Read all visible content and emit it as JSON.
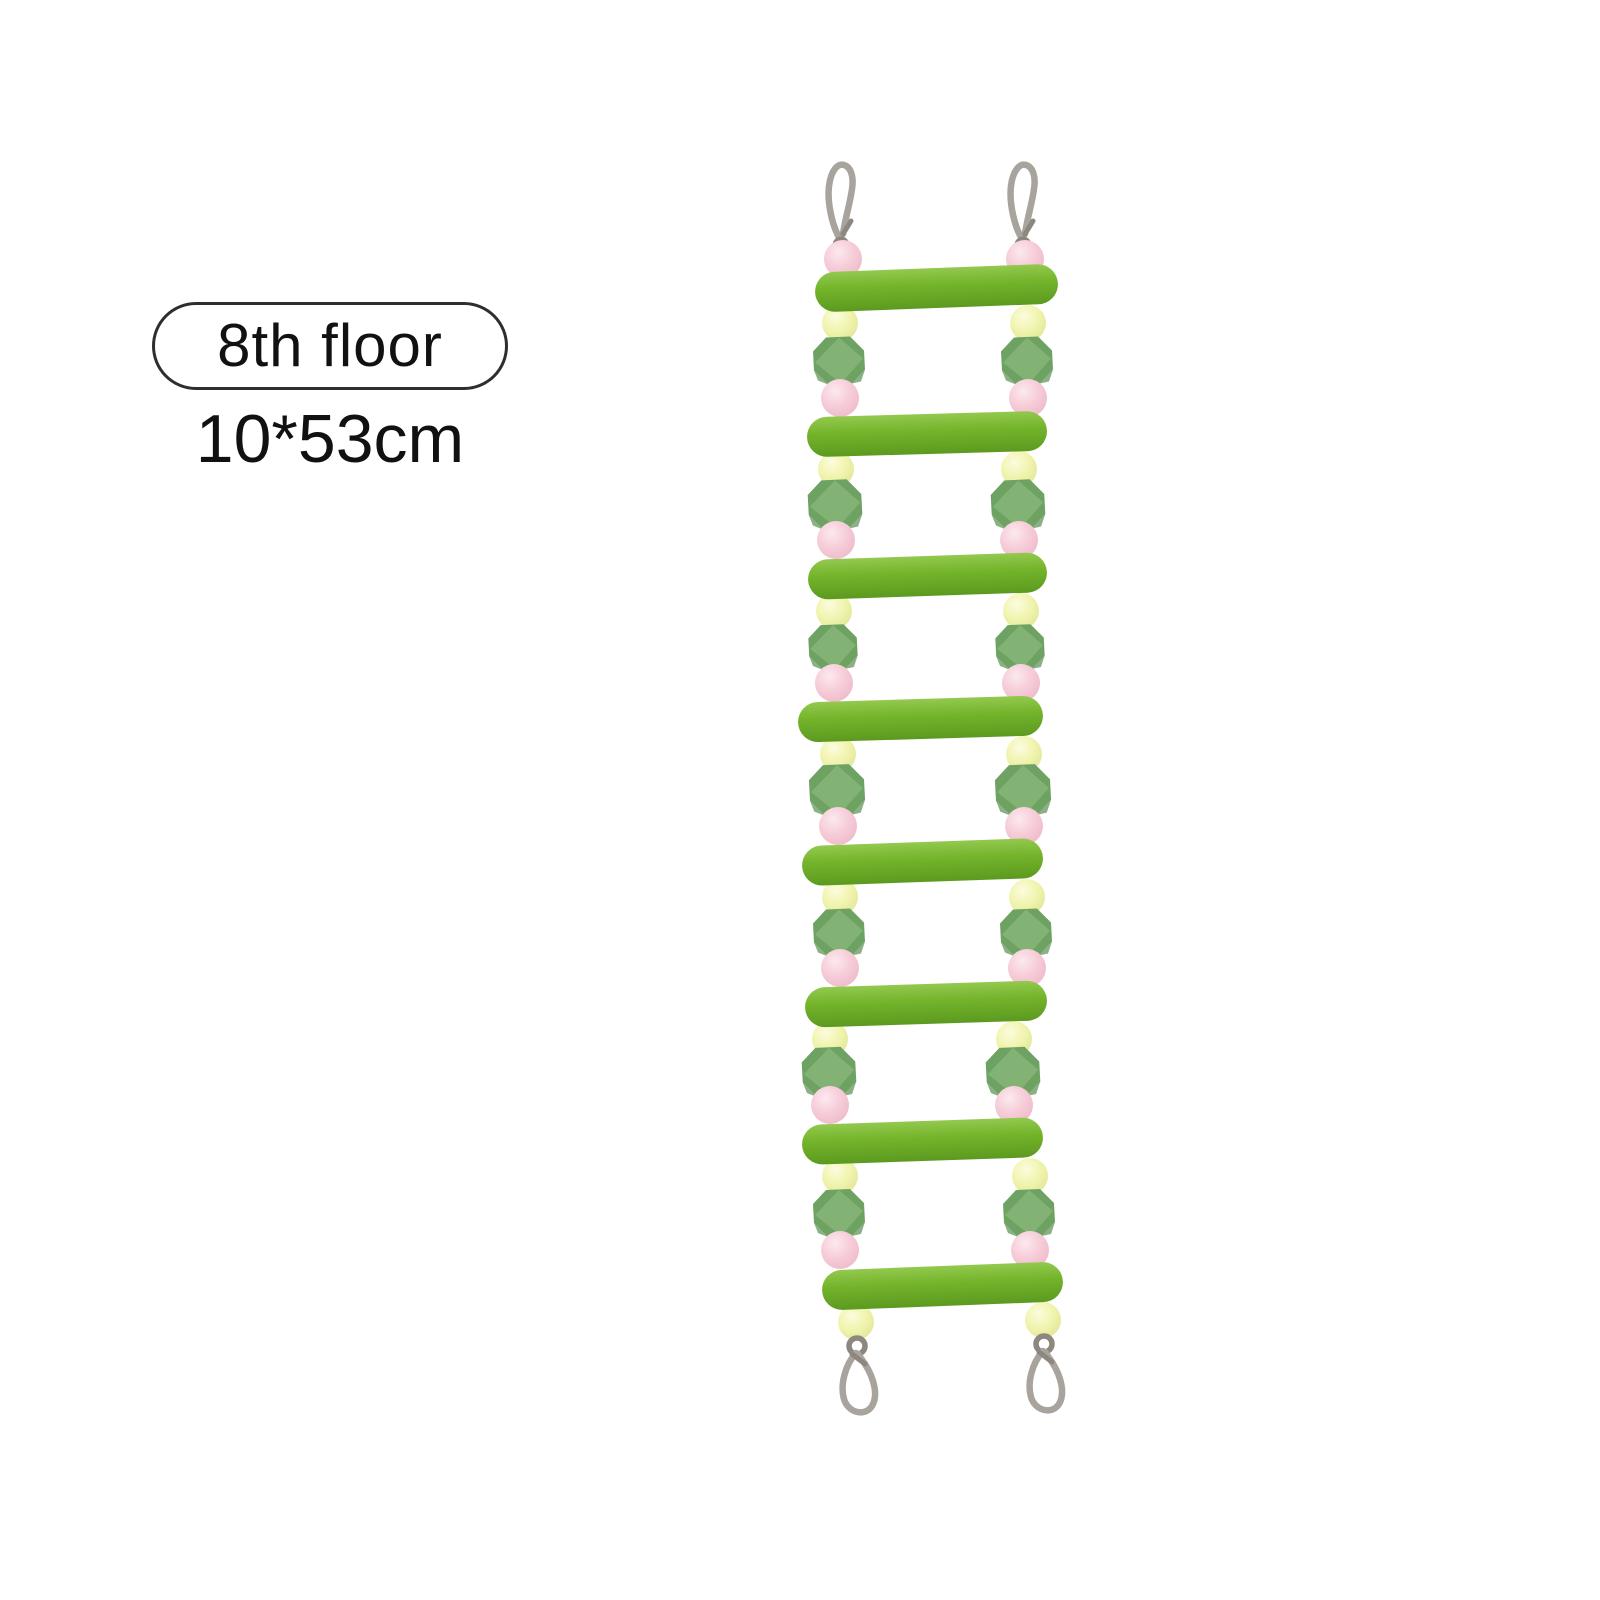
{
  "page": {
    "background": "#ffffff"
  },
  "annotation": {
    "floor_label": "8th floor",
    "size_label": "10*53cm"
  },
  "product": {
    "name": "bird-ladder-toy",
    "rung_count": 8,
    "hook_count_top": 2,
    "hook_count_bottom": 2,
    "bead_above_first_rung": "pink-round",
    "bead_pattern_between_rungs": [
      "yellow-round",
      "green-faceted",
      "pink-round"
    ],
    "bead_below_last_rung": "yellow-round",
    "colors": {
      "rung_green": "#74b42a",
      "rung_green_light": "#93c94f",
      "rung_green_dark": "#5c9a20",
      "bead_yellow": "#f1f4ae",
      "bead_yellow_highlight": "#fbfcdf",
      "bead_yellow_shade": "#dde394",
      "bead_pink": "#f6ccd8",
      "bead_pink_highlight": "#fce9ef",
      "bead_pink_shade": "#ecb5c5",
      "bead_green": "#6da263",
      "bead_green_light": "#84b577",
      "bead_green_dark": "#5b8f52",
      "metal": "#a8a39c",
      "metal_dark": "#8d8780",
      "badge_outline": "#2e2e2e",
      "text": "#111111"
    }
  }
}
